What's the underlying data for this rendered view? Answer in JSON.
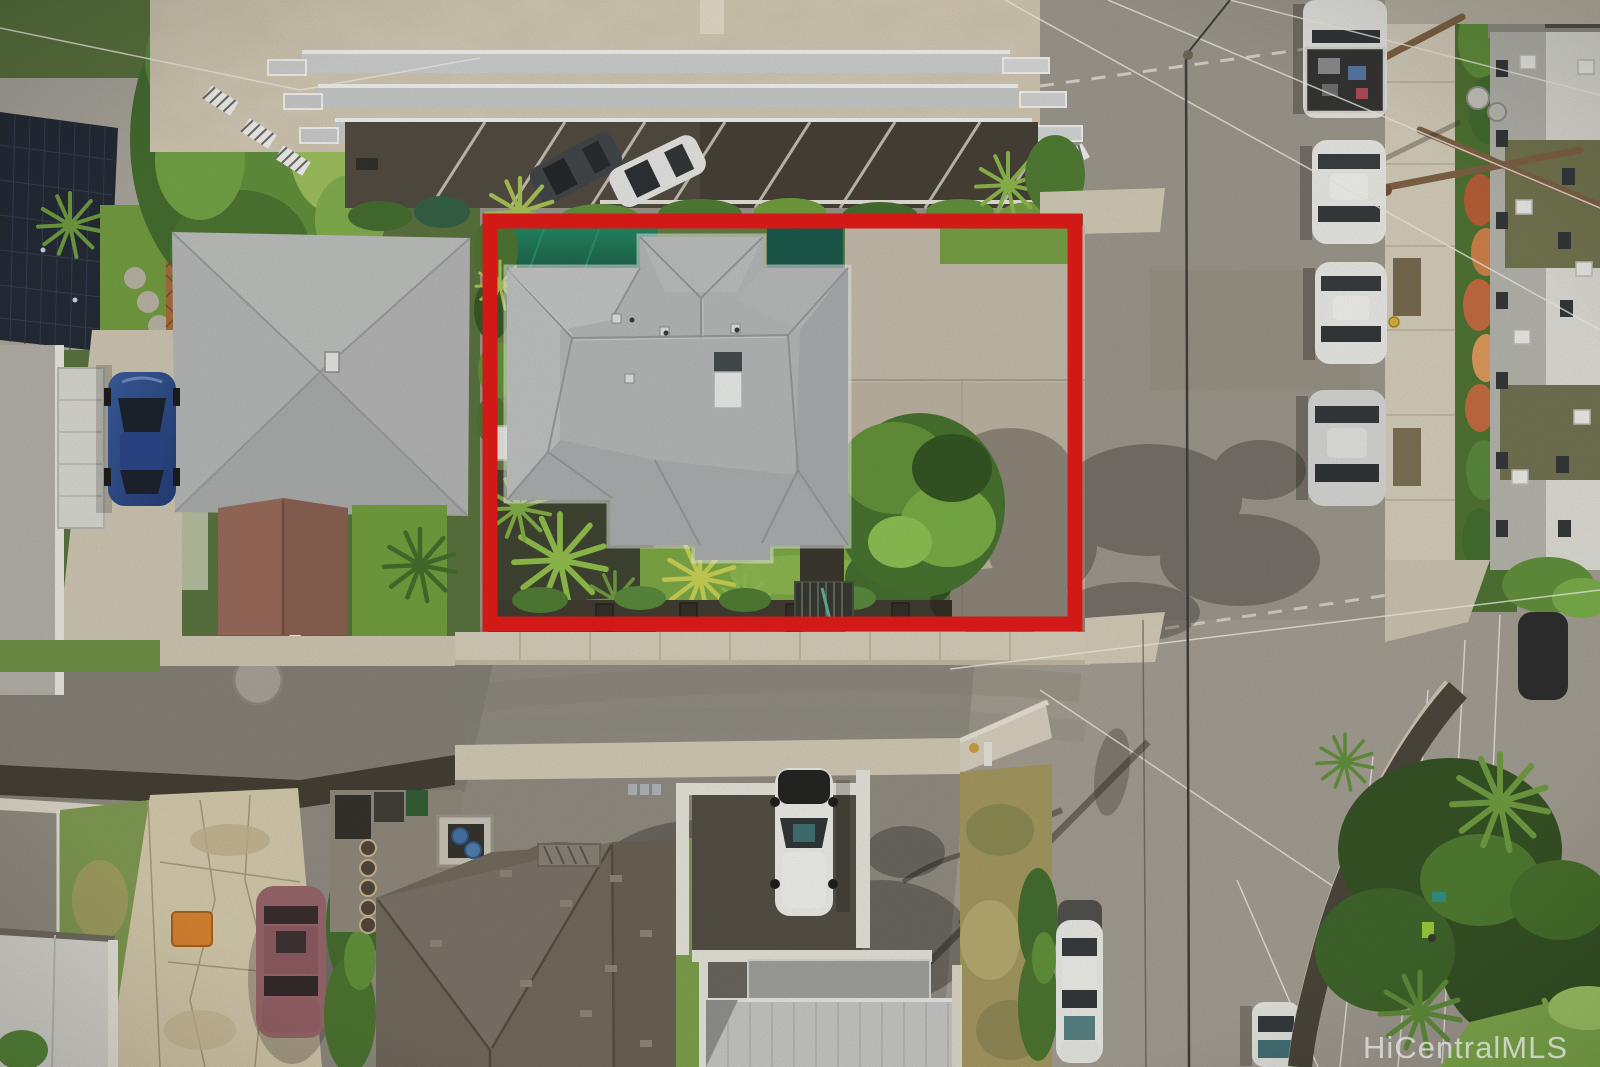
{
  "watermark": {
    "text": "HiCentralMLS",
    "color": "#ececec"
  },
  "colors": {
    "outline_red": "#e31414"
  },
  "scene": {
    "kind": "aerial-photo",
    "highlight": "red rectangle outlining subject property"
  }
}
